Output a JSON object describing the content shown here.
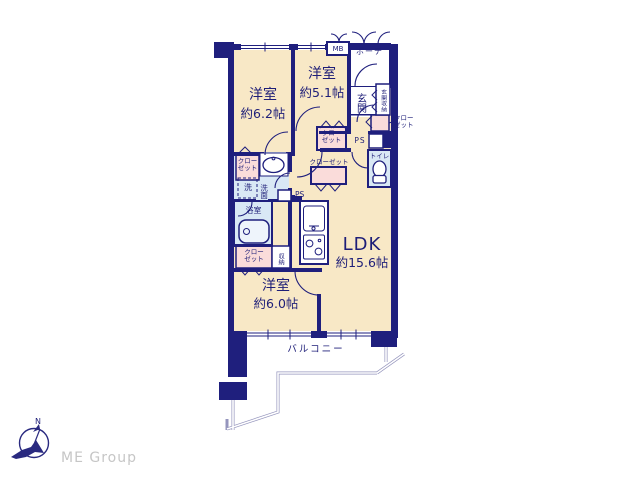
{
  "plan": {
    "rooms": {
      "bedroom_62": {
        "label": "洋室",
        "size": "約6.2帖"
      },
      "bedroom_51": {
        "label": "洋室",
        "size": "約5.1帖"
      },
      "bedroom_60": {
        "label": "洋室",
        "size": "約6.0帖"
      },
      "ldk": {
        "label": "LDK",
        "size": "約15.6帖"
      },
      "balcony": {
        "label": "バルコニー"
      },
      "porch": {
        "label": "ポーチ"
      },
      "meter_box": {
        "label": "MB"
      },
      "entrance": {
        "label": "玄関"
      },
      "entrance_storage": {
        "label": "玄関収納"
      },
      "toilet": {
        "label": "トイレ"
      },
      "bathroom": {
        "label": "浴室"
      },
      "washroom": {
        "label": "洗面"
      },
      "laundry": {
        "label": "洗"
      },
      "storage": {
        "label": "収納"
      },
      "pipe_space_right": {
        "label": "PS"
      },
      "pipe_space_center": {
        "label": "PS"
      }
    },
    "closets": {
      "hall_upper": {
        "lines": [
          "クロー",
          "ゼット"
        ]
      },
      "hall_center": {
        "label": "クローゼット"
      },
      "entrance_side": {
        "lines": [
          "クロー",
          "ゼット"
        ]
      },
      "washroom_side": {
        "lines": [
          "クロー",
          "ゼット"
        ]
      },
      "bedroom60_side": {
        "lines": [
          "クロー",
          "ゼット"
        ]
      }
    }
  },
  "footer": {
    "brand": "ME Group",
    "compass_north": "N"
  },
  "palette": {
    "wall_navy": "#1f1f7d",
    "room_cream": "#f8e8c6",
    "closet_pink": "#fadcda",
    "wet_blue": "#d9e8f5",
    "railing_gray": "#9595bd",
    "logo_gray": "#c6c6c6"
  }
}
